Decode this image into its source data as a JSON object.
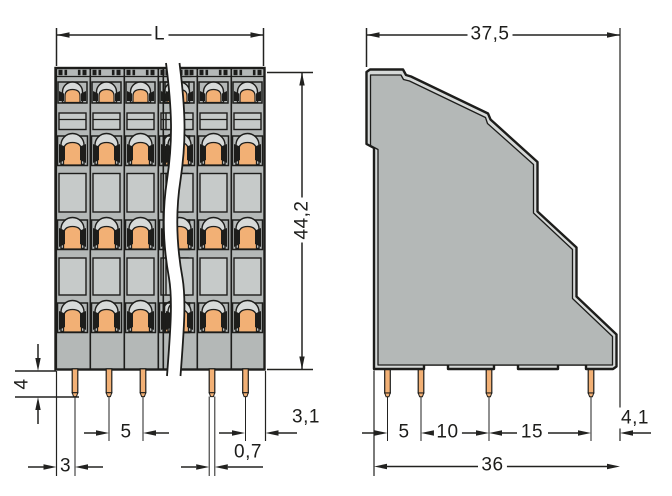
{
  "front_view": {
    "dims": {
      "length": "L",
      "height": "44,2",
      "pin_length": "4",
      "pin_pitch": "5",
      "edge_to_pin": "3",
      "pin_width": "0,7",
      "edge_right": "3,1"
    }
  },
  "side_view": {
    "dims": {
      "depth": "37,5",
      "pitch_a": "5",
      "pitch_b": "10",
      "pitch_c": "15",
      "edge_right": "4,1",
      "overall_bottom": "36"
    }
  },
  "colors": {
    "body_gray": "#b4b8b7",
    "recess_gray": "#d6d9d8",
    "window_gray": "#c6cac9",
    "clamp_orange": "#f2b075",
    "line_dark": "#1d1d1b"
  }
}
